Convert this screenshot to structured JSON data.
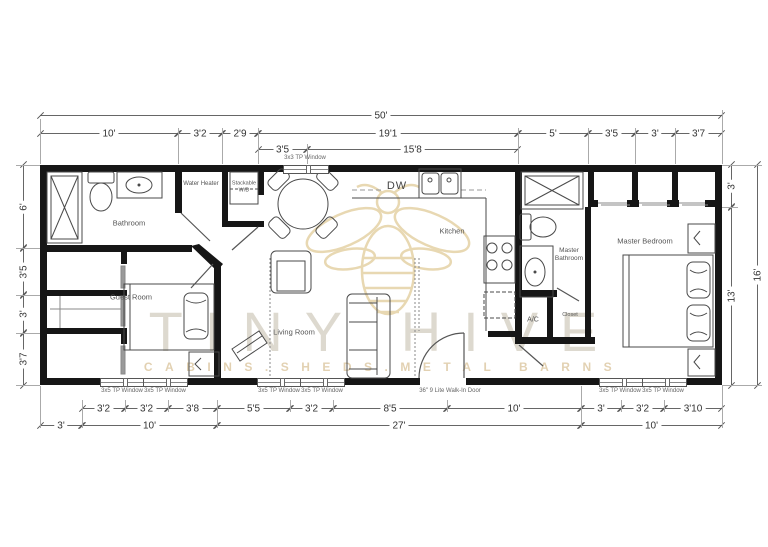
{
  "watermark": {
    "brand": "TINY HIVE",
    "tagline": "CABINS.SHEDS.METAL BARNS"
  },
  "room_labels": {
    "bathroom": "Bathroom",
    "guest_room": "Guest Room",
    "living_room": "Living Room",
    "kitchen": "Kitchen",
    "master_bathroom": "Master Bathroom",
    "master_bedroom": "Master Bedroom",
    "water_heater": "Water Heater",
    "stackable_wd": "Stackable W/D",
    "ac_closet": "A/C",
    "closet": "Closet",
    "dishwasher": "DW"
  },
  "openings": {
    "window_3x3": "3x3 TP Window",
    "window_3x5": "3x5 TP Window",
    "walk_in_door": "36\" 9 Lite Walk-In Door"
  },
  "dimensions": {
    "overall_width": "50'",
    "overall_height": "16'",
    "top_row": [
      "10'",
      "3'2",
      "2'9",
      "19'1",
      "5'",
      "3'5",
      "3'",
      "3'7"
    ],
    "top_sub_row": [
      "3'5",
      "15'8"
    ],
    "left_col": [
      "6'",
      "3'5",
      "3'",
      "3'7"
    ],
    "right_col": [
      "3'",
      "13'"
    ],
    "bottom_row_1": [
      "3'2",
      "3'2",
      "3'8",
      "5'5",
      "3'2",
      "8'5",
      "10'",
      "3'",
      "3'2",
      "3'10"
    ],
    "bottom_row_2": [
      "3'",
      "10'",
      "27'",
      "10'"
    ]
  },
  "colors": {
    "wall": "#161616",
    "line": "#4a4a4a",
    "watermark_brand": "#d8d3c7",
    "watermark_tagline": "#dcc6a0",
    "watermark_bee": "#e8d8b2"
  }
}
